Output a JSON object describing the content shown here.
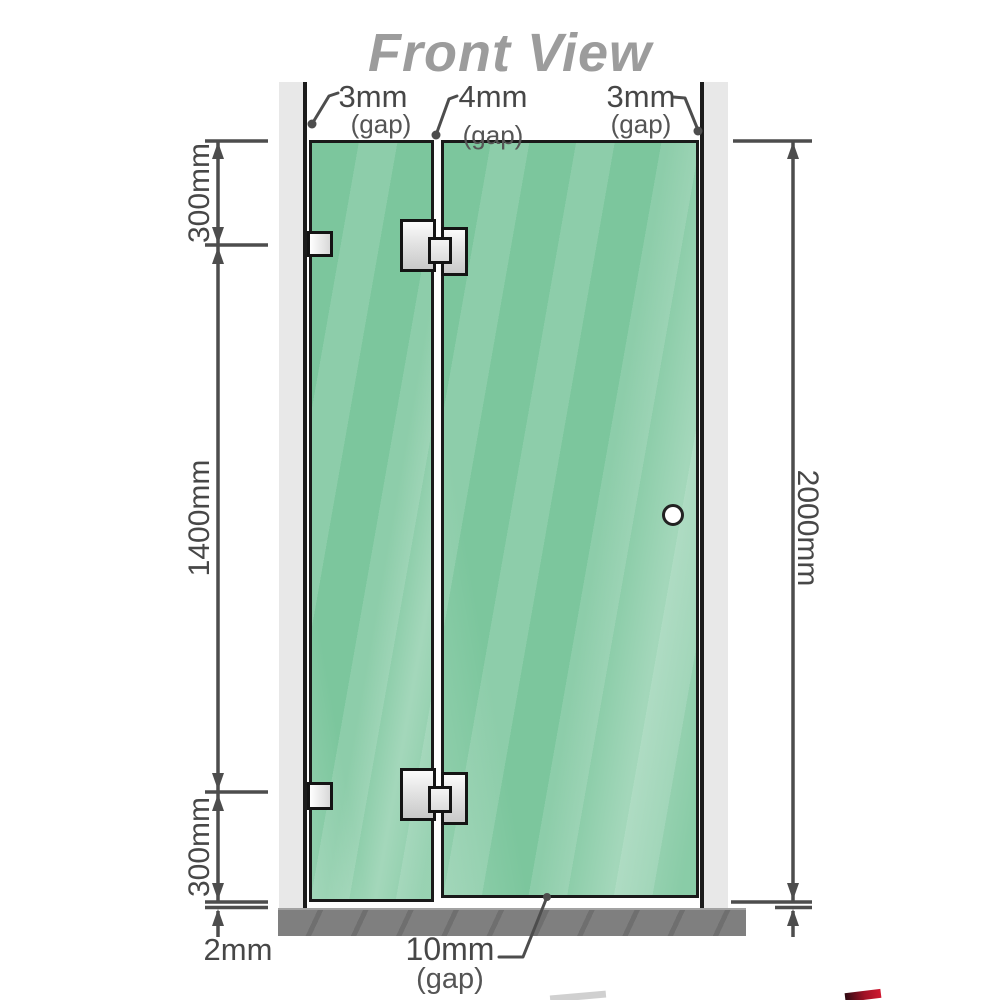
{
  "title": "Front View",
  "labels": {
    "gap_left": {
      "value": "3mm",
      "qualifier": "(gap)"
    },
    "gap_middle": {
      "value": "4mm",
      "qualifier": "(gap)"
    },
    "gap_right": {
      "value": "3mm",
      "qualifier": "(gap)"
    },
    "gap_bottom": {
      "value": "10mm",
      "qualifier": "(gap)"
    },
    "floor_gap": {
      "value": "2mm"
    }
  },
  "dimensions": {
    "left": [
      {
        "label": "300mm"
      },
      {
        "label": "1400mm"
      },
      {
        "label": "300mm"
      }
    ],
    "right": {
      "label": "2000mm"
    }
  },
  "colors": {
    "glass": "#7cc69d",
    "wall_channel": "#e8e8e8",
    "floor": "#7f7f7f",
    "dimension_line": "#4d4d4d",
    "title_text": "#9c9c9c",
    "hardware": "#e3e3e3",
    "watermark_red": "#a01226"
  }
}
